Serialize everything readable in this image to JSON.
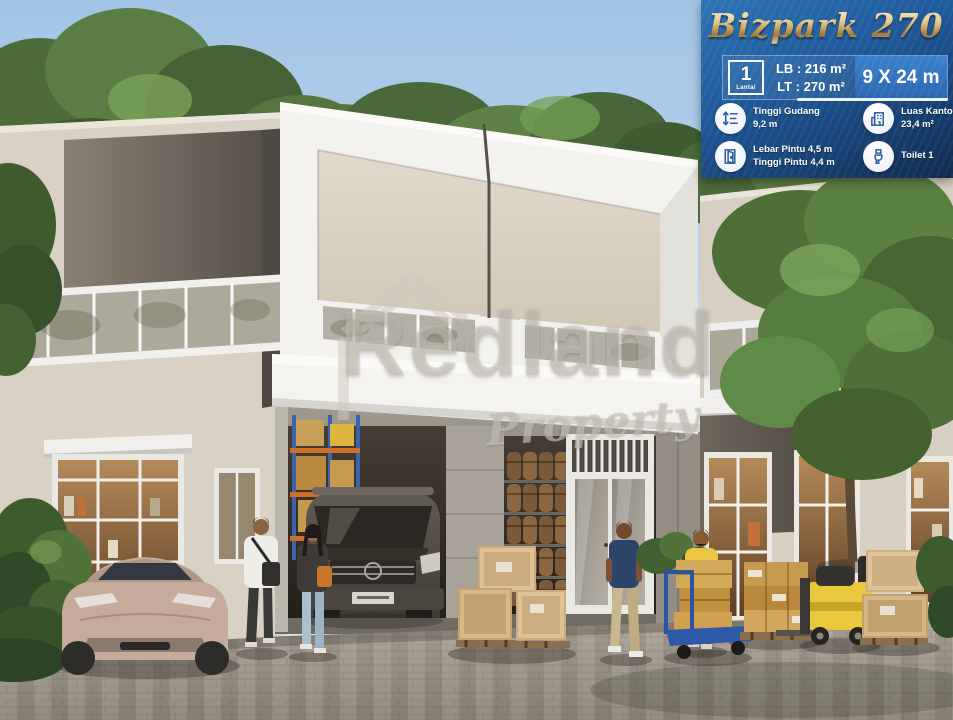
{
  "panel": {
    "title": "Bizpark 270",
    "floors": {
      "value": "1",
      "label": "Lantai"
    },
    "building_area": "LB : 216 m²",
    "land_area": "LT : 270 m²",
    "dimensions": "9 X 24 m",
    "features": [
      {
        "icon": "height-measure-icon",
        "line1": "Tinggi Gudang",
        "line2": "9,2 m"
      },
      {
        "icon": "door-icon",
        "line1": "Lebar Pintu 4,5 m",
        "line2": "Tinggi Pintu 4,4 m"
      },
      {
        "icon": "office-building-icon",
        "line1": "Luas Kantor",
        "line2": "23,4 m²"
      },
      {
        "icon": "toilet-icon",
        "line1": "Toilet 1",
        "line2": ""
      }
    ],
    "colors": {
      "panel_top": "#2e74b5",
      "panel_bottom": "#102a4d",
      "dims_box": "#2a66b0",
      "gold": "#dcbe84",
      "icon_blue": "#2a5d9e"
    }
  },
  "watermark": {
    "brand": "Redland",
    "subtitle": "Property"
  }
}
